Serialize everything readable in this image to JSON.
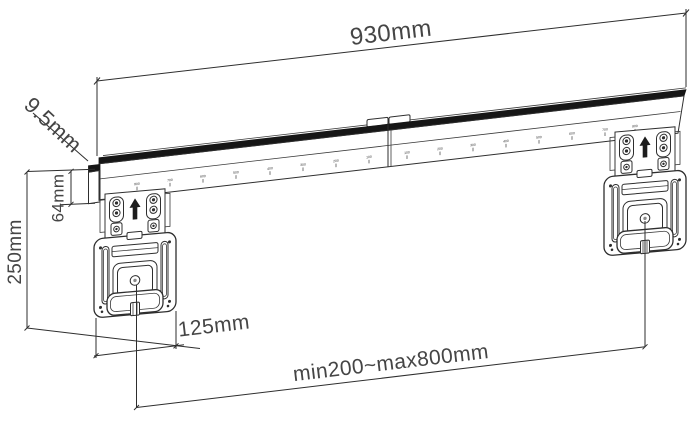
{
  "diagram": {
    "dimensions": {
      "rail_width": "930mm",
      "profile_depth": "9.5mm",
      "rail_height": "64mm",
      "bracket_height": "250mm",
      "bracket_width": "125mm",
      "mount_range": "min200~max800mm"
    },
    "rail": {
      "scale_marks": [
        "800",
        "700",
        "600",
        "500",
        "400",
        "300",
        "200",
        "100",
        "100",
        "200",
        "300",
        "400",
        "500",
        "600",
        "700",
        "800"
      ]
    },
    "colors": {
      "line": "#2e2e2e",
      "rail_band": "#161616",
      "text": "#454545",
      "background": "#ffffff"
    }
  }
}
